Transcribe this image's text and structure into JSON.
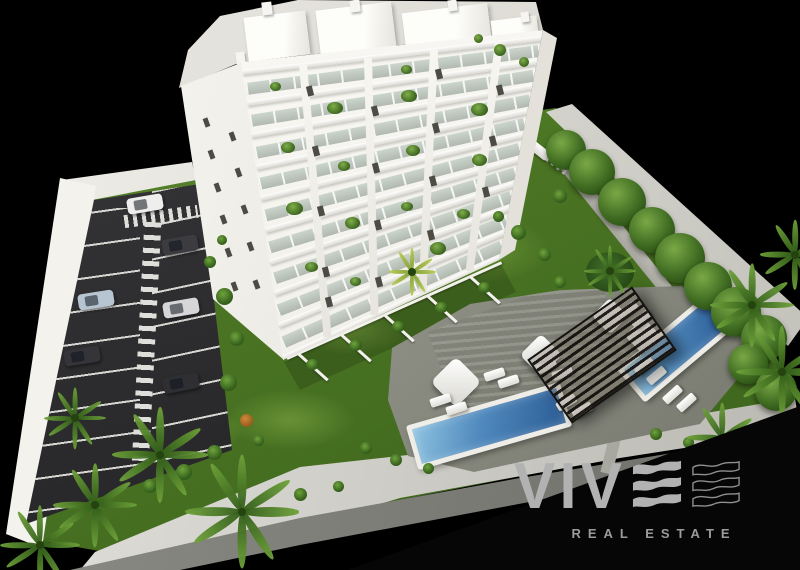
{
  "logo": {
    "brand": "VIV",
    "brand_full": "VIVE",
    "wave_icon": "wave-e-filled",
    "wave_outline_icon": "wave-e-outline",
    "tagline": "REAL ESTATE",
    "brand_color": "#b2b2b2",
    "wave_outline_color": "#8f8f8f",
    "tagline_color": "#9c9c9c"
  },
  "scene": {
    "background_color": "#000000",
    "building": {
      "label": "white-apartment-tower",
      "floors_visible": 9,
      "facade_color": "#f8f7f2",
      "roof_color": "#dcdad3"
    },
    "parking": {
      "asphalt_color": "#2d2d2f",
      "marking_color": "#d6d6d2",
      "cars": [
        {
          "color": "#eeeeec"
        },
        {
          "color": "#3b3b40"
        },
        {
          "color": "#b7c5d3"
        },
        {
          "color": "#d6d6d8"
        },
        {
          "color": "#343439"
        },
        {
          "color": "#2f2f33"
        }
      ]
    },
    "landscape": {
      "grass_color": "#497522",
      "tree_color": "#35591c",
      "palm_color": "#4e7d28"
    },
    "pool_area": {
      "pool_count": 2,
      "water_color": "#3f74ad",
      "deck_color": "#8f9187",
      "pergola_color": "#1c1915",
      "furniture_color": "#f4f3ee"
    },
    "walls_color": "#e8e7e1"
  }
}
